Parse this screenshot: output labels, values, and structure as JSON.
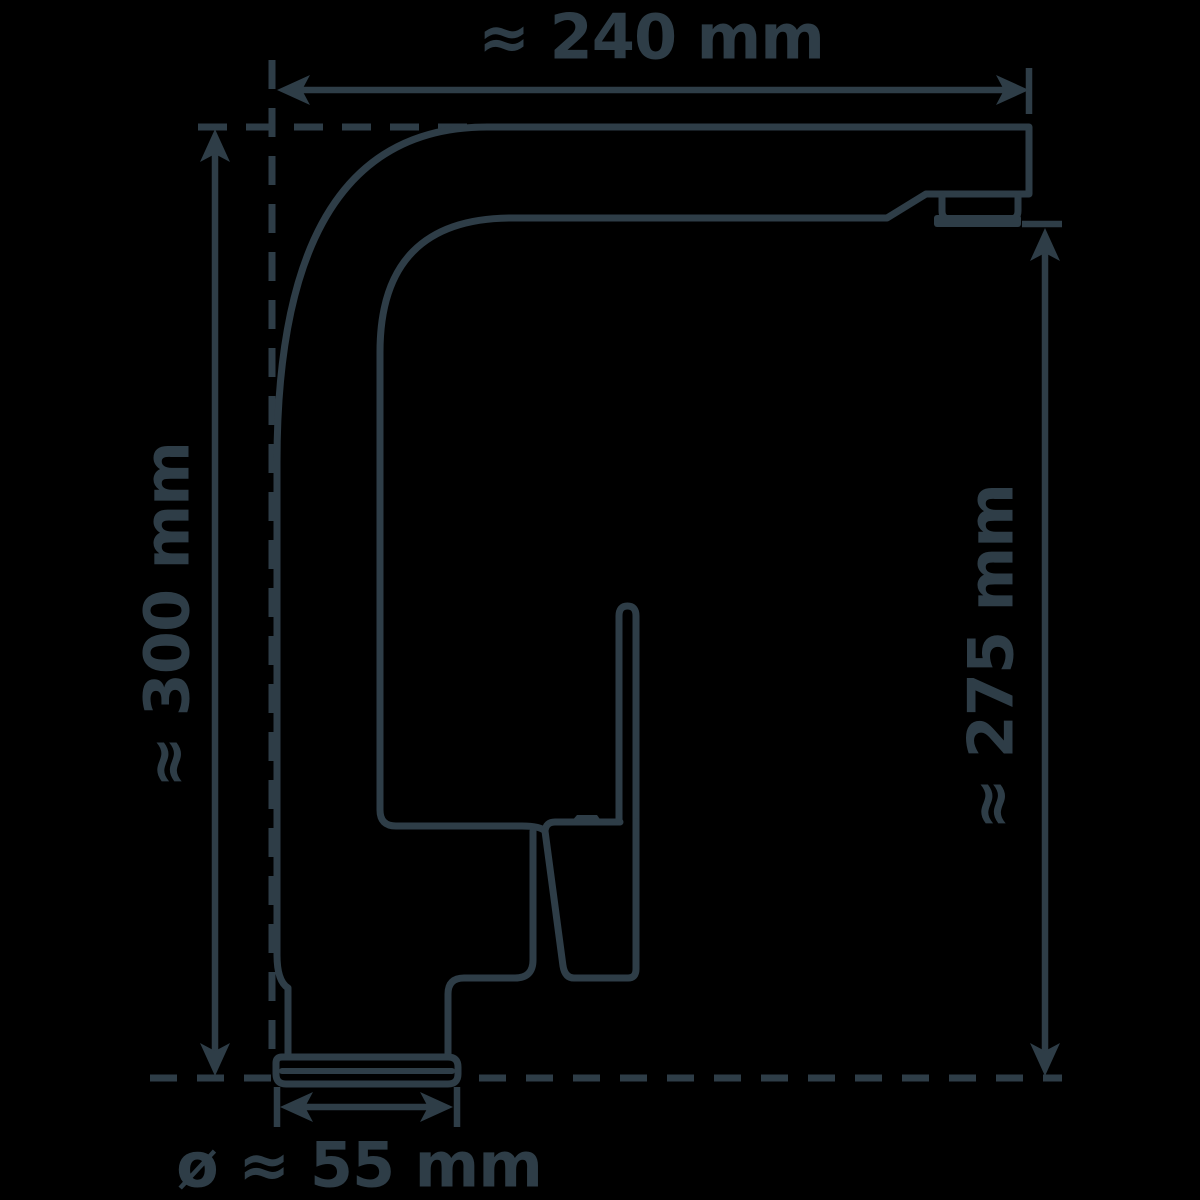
{
  "diagram": {
    "type": "technical dimension drawing",
    "subject": "single-lever kitchen faucet, side profile",
    "background_color": "#000000",
    "line_color": "#2e3d47",
    "unit": "mm",
    "dimensions": {
      "spout_reach_top": {
        "label": "≈ 240 mm",
        "value": 240,
        "position": "top horizontal"
      },
      "total_height_left": {
        "label": "≈ 300 mm",
        "value": 300,
        "position": "left vertical"
      },
      "spout_height_right": {
        "label": "≈ 275 mm",
        "value": 275,
        "position": "right vertical"
      },
      "base_diameter_bottom": {
        "label": "ø ≈ 55 mm",
        "value": 55,
        "position": "bottom horizontal"
      }
    }
  }
}
